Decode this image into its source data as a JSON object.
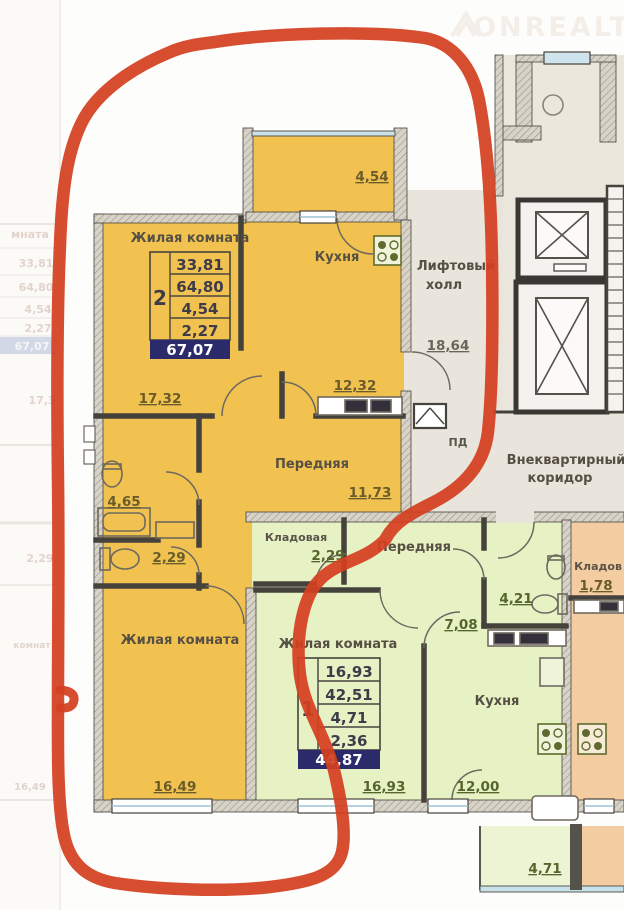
{
  "watermark": {
    "brand": "ONREALT"
  },
  "left_preview": {
    "header_fragment": "мната",
    "rows": [
      "33,81",
      "64,80",
      "4,54",
      "2,27"
    ],
    "total": "67,07",
    "dim_a": "17,3",
    "dim_b": "2,29",
    "fragment2": "комнат",
    "dim_c": "16,49"
  },
  "apartment2": {
    "living1": {
      "label": "Жилая комната",
      "dim": "17,32"
    },
    "table": {
      "unit": "2",
      "rows": [
        "33,81",
        "64,80",
        "4,54",
        "2,27"
      ],
      "total": "67,07"
    },
    "kitchen": {
      "label": "Кухня",
      "dim": "12,32"
    },
    "balcony": {
      "dim": "4,54"
    },
    "hall": {
      "label": "Передняя",
      "dim": "11,73"
    },
    "bath": {
      "dim": "4,65"
    },
    "wc": {
      "dim": "2,29"
    },
    "living2": {
      "label": "Жилая комната",
      "dim": "16,49"
    }
  },
  "apartment1": {
    "storage": {
      "label": "Кладовая",
      "dim": "2,29"
    },
    "hall": {
      "label": "Передняя",
      "dim": "7,08"
    },
    "bath": {
      "dim": "4,21"
    },
    "living": {
      "label": "Жилая комната",
      "dim": "16,93"
    },
    "table": {
      "unit": "1",
      "rows": [
        "16,93",
        "42,51",
        "4,71",
        "2,36"
      ],
      "total": "44,87"
    },
    "kitchen": {
      "label": "Кухня",
      "dim": "12,00"
    },
    "balcony": {
      "dim": "4,71"
    }
  },
  "common": {
    "elevator_hall": {
      "label_lines": [
        "Лифтовый",
        "холл"
      ],
      "dim": "18,64",
      "pd_label": "ПД"
    },
    "corridor": {
      "label_lines": [
        "Внеквартирный",
        "коридор"
      ]
    }
  },
  "neighbor": {
    "storage": {
      "label": "Кладов",
      "dim": "1,78"
    }
  },
  "colors": {
    "annotation_red": "#d43f20",
    "apartment2_fill": "#f2c251",
    "apartment1_fill": "#e6f1c4",
    "neighbor_fill": "#f3cda1",
    "common_fill": "#eae5dc",
    "table_footer": "#2b2a6b"
  }
}
